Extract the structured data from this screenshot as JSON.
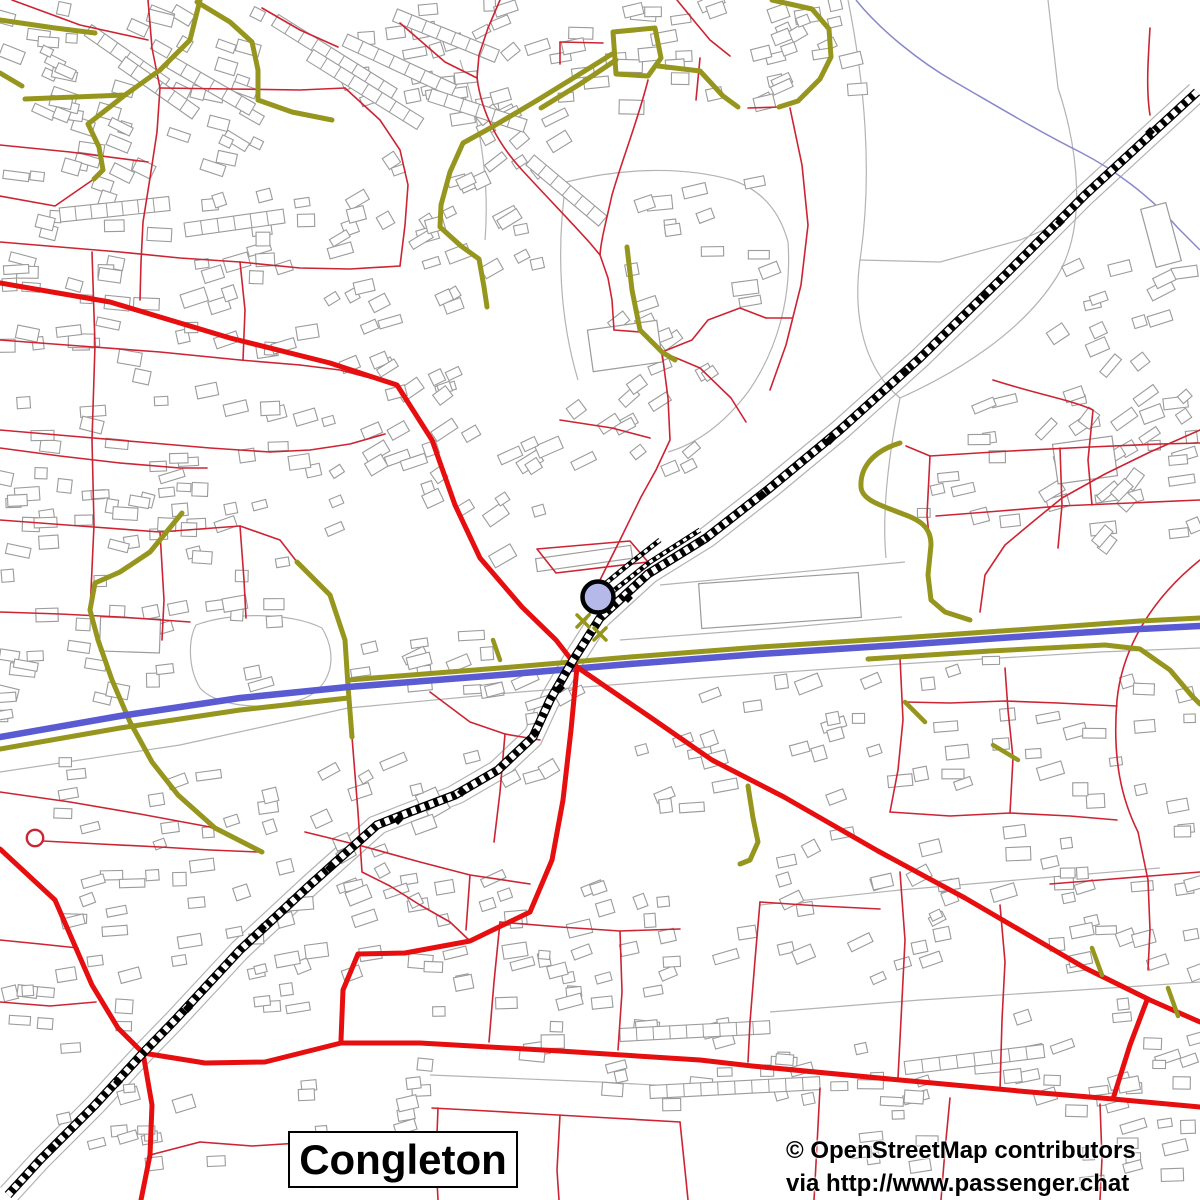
{
  "map": {
    "place_label": "Congleton",
    "attribution_line1": "© OpenStreetMap contributors",
    "attribution_line2": "via http://www.passenger.chat",
    "colors": {
      "background": "#ffffff",
      "road_minor": "#cd2332",
      "road_primary": "#e60e0e",
      "road_b": "#96961e",
      "trunk_blue": "#5a5ad2",
      "stream": "#8888cc",
      "building_stroke": "#9b9b9b",
      "boundary": "#b3b3b3",
      "railway": "#000000",
      "marker_fill": "#b4b9ea",
      "marker_stroke": "#000000",
      "label_text": "#000000"
    },
    "marker": {
      "cx": 598,
      "cy": 597,
      "r": 15.5
    },
    "roundabout": {
      "cx": 35,
      "cy": 838,
      "r": 8.2
    },
    "railway_points": [
      [
        1197,
        92
      ],
      [
        1085,
        195
      ],
      [
        1000,
        280
      ],
      [
        920,
        358
      ],
      [
        840,
        430
      ],
      [
        770,
        488
      ],
      [
        706,
        538
      ],
      [
        648,
        574
      ],
      [
        600,
        618
      ],
      [
        572,
        662
      ],
      [
        550,
        700
      ],
      [
        533,
        737
      ],
      [
        498,
        770
      ],
      [
        455,
        795
      ],
      [
        410,
        812
      ],
      [
        377,
        825
      ],
      [
        310,
        885
      ],
      [
        240,
        950
      ],
      [
        175,
        1020
      ],
      [
        143,
        1053
      ],
      [
        95,
        1105
      ],
      [
        40,
        1160
      ],
      [
        8,
        1195
      ]
    ],
    "railway_spurs": [
      [
        [
          700,
          530
        ],
        [
          650,
          562
        ],
        [
          612,
          592
        ],
        [
          588,
          612
        ]
      ],
      [
        [
          660,
          540
        ],
        [
          628,
          565
        ],
        [
          600,
          588
        ]
      ]
    ],
    "railway_diamonds": [
      [
        1150,
        132
      ],
      [
        1060,
        222
      ],
      [
        985,
        295
      ],
      [
        905,
        372
      ],
      [
        830,
        440
      ],
      [
        762,
        495
      ],
      [
        700,
        542
      ],
      [
        628,
        598
      ],
      [
        560,
        688
      ],
      [
        535,
        733
      ],
      [
        462,
        792
      ],
      [
        398,
        820
      ],
      [
        330,
        868
      ],
      [
        262,
        928
      ],
      [
        188,
        1008
      ],
      [
        118,
        1082
      ],
      [
        52,
        1148
      ]
    ],
    "trunk": {
      "blue": "M 0,737 L 120,716 240,698 348,687 500,675 630,664 760,654 900,645 1030,636 1140,629 1200,626",
      "casings": [
        "M 0,749 L 120,728 240,710 348,698",
        "M 348,680 L 500,668 630,657 760,647 900,638 1030,629 1140,621 1200,618",
        "M 868,659 L 990,651 1105,645 1140,649 1170,670 1192,696 1200,704"
      ]
    },
    "stream": "M 856,0 C 880,30 920,62 955,82 C 1000,108 1040,132 1080,152 C 1115,170 1150,196 1178,228 L 1200,250",
    "olive_roads": [
      "M 0,20 L 55,28 95,33",
      "M 0,73 L 22,86",
      "M 197,2 L 230,22 252,42 258,70 258,100",
      "M 258,100 L 292,112 332,120",
      "M 200,0 L 190,40 160,70 125,95 25,99",
      "M 125,95 L 88,124 99,147 103,170 94,179",
      "M 536,101 L 575,77 612,54",
      "M 541,108 L 580,84 616,60",
      "M 613,32 L 655,28 661,58 648,76 616,74 Z",
      "M 658,66 L 700,71 723,96 738,107",
      "M 772,0 L 812,9 829,29 831,57 820,79 798,101 779,107",
      "M 536,101 L 492,127 463,143 450,172 441,205 440,227 461,246 479,259 484,287 487,307",
      "M 627,247 L 632,290 640,330 662,352 675,360",
      "M 900,443 C 870,452 860,470 861,487 C 862,500 880,505 903,514 C 920,520 931,527 931,545 L 928,575 931,600 945,612 970,620",
      "M 297,562 L 330,595 345,640 348,686 352,737",
      "M 182,513 L 150,552 120,572 95,583 90,610 98,640 112,680 130,722 152,762 178,795 215,828 262,852",
      "M 748,786 L 753,818 758,842 750,860 740,864"
    ],
    "olive_marks": [
      "M 1092,948 L 1102,975",
      "M 1168,988 L 1178,1016",
      "M 493,640 L 500,660",
      "M 993,745 L 1018,760",
      "M 905,702 L 925,722"
    ],
    "crossing_marks": [
      [
        583,
        621
      ],
      [
        600,
        634
      ]
    ],
    "red_primary": [
      "M 0,283 L 110,302 230,338 330,363 397,385 432,440 455,505 480,558 522,607 556,640 577,667 650,717 712,760 784,797 878,851 965,898 1085,968 1150,1000 1200,1022",
      "M 577,667 L 571,730 563,800 552,860 530,912 470,941 405,953 358,954 343,990 341,1040",
      "M 0,849 L 55,900 92,985 118,1028 143,1053 205,1063 265,1062 341,1043 420,1043 560,1051 700,1060 752,1066 900,1080 1030,1092 1113,1099 1200,1107",
      "M 143,1053 L 152,1105 150,1155 141,1200",
      "M 1147,1000 L 1130,1045 1113,1099"
    ],
    "red_roads": [
      "M 12,0 L 80,25 148,40",
      "M 148,0 L 152,48 160,88 157,132 150,178 143,222 141,262 140,300",
      "M 160,88 L 230,89 300,90 345,88",
      "M 262,8 L 300,30 338,47",
      "M 400,23 L 445,62 477,78",
      "M 500,0 L 488,28 479,55 477,78",
      "M 477,78 C 482,115 500,146 522,170 C 546,196 573,224 590,243 L 600,255 608,278 612,300 614,330",
      "M 677,0 L 695,22 710,40 730,56",
      "M 648,80 C 638,120 622,160 612,195 C 606,222 601,240 600,255",
      "M 560,42 L 603,43",
      "M 560,42 L 560,64",
      "M 0,145 L 70,152 148,162",
      "M 0,196 L 55,206 94,179",
      "M 0,242 L 60,247 120,252 180,258 240,262",
      "M 240,262 L 300,268 350,269 400,266",
      "M 345,88 L 380,120 400,150 408,185 405,225 400,266",
      "M 0,340 L 80,346 160,352 240,360 300,365",
      "M 300,365 L 340,370 370,378 397,385",
      "M 240,262 L 245,310 243,360",
      "M 92,252 L 95,345 92,440",
      "M 0,430 L 70,436 140,442 210,448 270,452",
      "M 270,452 L 310,450 350,444 385,434",
      "M 92,440 L 94,525 90,612",
      "M 0,520 L 80,526 160,532 240,526",
      "M 240,526 L 280,540 297,562",
      "M 160,532 L 164,600 162,640",
      "M 0,612 L 60,614 120,617 190,622",
      "M 240,526 L 244,580 246,618",
      "M 1150,28 C 1148,60 1146,90 1150,115",
      "M 700,58 L 696,100",
      "M 662,352 L 692,340 708,320 740,308 766,318",
      "M 766,318 L 792,318",
      "M 662,352 L 700,368 731,398 746,422",
      "M 662,352 L 668,398 670,440 656,470 641,497 620,540 605,570 598,584",
      "M 560,420 L 612,428 650,438",
      "M 748,108 L 779,107",
      "M 790,108 L 802,165 808,225 801,285 786,345 770,390",
      "M 537,549 L 630,541 648,562 556,573 Z",
      "M 930,456 L 1010,451 1090,447 1160,444 1200,443",
      "M 930,456 L 927,515 931,556",
      "M 1060,448 L 1062,505 1058,548",
      "M 1200,500 L 1130,503 1060,506 1000,511 936,516",
      "M 930,456 L 906,446",
      "M 1200,430 L 1150,452 1105,474 1062,498 1035,520 1005,545 985,575 980,612",
      "M 1200,560 C 1150,600 1122,650 1117,700 C 1112,760 1122,800 1138,832 L 1148,880 1150,930 1148,970",
      "M 900,658 L 903,720 898,770 890,812",
      "M 890,812 L 950,816 1010,813 1070,816 1117,820",
      "M 1010,813 L 1013,758 1008,710 1005,668",
      "M 1117,706 L 1058,703 1005,701 950,703 905,702",
      "M 900,872 L 905,940 902,1000 898,1078",
      "M 1000,905 L 1005,962 1002,1020 1000,1090",
      "M 760,902 L 820,906 880,909",
      "M 760,902 L 755,960 750,1022 748,1062",
      "M 1200,872 L 1150,876 1100,880 1050,884",
      "M 950,1098 L 945,1150 941,1200",
      "M 1100,1104 L 1102,1158 1100,1200",
      "M 820,1088 L 817,1145 814,1200",
      "M 500,922 L 560,927 620,931 680,929",
      "M 620,931 L 622,992 618,1050",
      "M 500,922 L 494,982 489,1042",
      "M 680,1122 L 610,1118 540,1114 470,1110 432,1108",
      "M 560,1115 L 557,1170 559,1200",
      "M 438,1108 L 436,1160 438,1200",
      "M 680,1122 L 686,1180 688,1200",
      "M 305,832 L 362,846 420,862 470,875 530,884",
      "M 470,875 L 466,930",
      "M 0,1002 L 50,1006 96,1002",
      "M 200,1142 L 252,1146 300,1143",
      "M 150,1155 L 200,1142",
      "M 43,841 L 100,844 160,847 210,850 258,852",
      "M 430,692 L 470,722 505,734 540,740",
      "M 505,734 L 500,792 494,842",
      "M 352,737 L 358,812 362,872 390,886",
      "M 0,792 L 70,802 140,814 210,827 262,852",
      "M 390,886 L 420,905 450,922 470,941",
      "M 0,448 L 60,456 120,463",
      "M 120,463 L 180,468 207,468",
      "M 0,940 L 40,944 78,948",
      "M 993,380 C 1040,395 1072,400 1093,410 L 1088,460 1092,505",
      "M 614,330 L 640,332 662,352"
    ],
    "gray_paths": [
      "M 0,772 L 180,745 348,708 520,692 700,678 900,664 1100,652 1200,648",
      "M 620,640 L 780,628 902,617",
      "M 848,0 C 866,90 872,180 860,260 C 852,320 866,370 900,398",
      "M 900,398 C 958,372 1022,332 1056,278 C 1088,228 1078,148 1058,88 L 1048,0",
      "M 860,260 L 940,262 1020,240 1058,224",
      "M 900,398 C 888,458 882,515 886,558",
      "M 566,182 C 622,168 682,166 732,180 C 762,190 780,212 788,242",
      "M 788,242 C 792,300 776,352 748,392 C 724,424 696,444 668,452",
      "M 566,182 C 556,250 560,320 578,380",
      "M 196,625 C 230,612 290,612 322,628 C 340,658 330,690 300,700 C 258,712 215,705 200,688 C 188,668 188,640 196,625 Z",
      "M 760,905 L 900,890 1040,878 1160,868",
      "M 770,1012 L 920,1000 1080,990 1200,982",
      "M 430,1075 L 600,1082 780,1092",
      "M 660,585 L 905,562",
      "M 460,60 C 480,120 490,180 485,240"
    ],
    "building_zones": [
      [
        0,
        5,
        150,
        195,
        36,
        15
      ],
      [
        150,
        0,
        110,
        170,
        22,
        20
      ],
      [
        340,
        0,
        170,
        135,
        24,
        -12
      ],
      [
        0,
        215,
        150,
        175,
        26,
        5
      ],
      [
        150,
        190,
        170,
        170,
        26,
        -8
      ],
      [
        320,
        150,
        140,
        180,
        22,
        -25
      ],
      [
        470,
        20,
        90,
        160,
        14,
        -30
      ],
      [
        560,
        0,
        130,
        120,
        18,
        -5
      ],
      [
        700,
        0,
        110,
        110,
        14,
        -20
      ],
      [
        0,
        400,
        150,
        195,
        28,
        3
      ],
      [
        150,
        380,
        180,
        200,
        30,
        -8
      ],
      [
        330,
        360,
        130,
        170,
        22,
        -25
      ],
      [
        570,
        300,
        140,
        170,
        20,
        -30
      ],
      [
        0,
        610,
        130,
        125,
        16,
        2
      ],
      [
        140,
        600,
        200,
        115,
        12,
        -5
      ],
      [
        360,
        600,
        130,
        90,
        11,
        -15
      ],
      [
        60,
        760,
        230,
        145,
        24,
        -10
      ],
      [
        300,
        760,
        140,
        130,
        14,
        -20
      ],
      [
        0,
        900,
        140,
        150,
        16,
        -5
      ],
      [
        150,
        880,
        170,
        130,
        16,
        -10
      ],
      [
        340,
        850,
        180,
        130,
        18,
        -15
      ],
      [
        420,
        950,
        180,
        120,
        16,
        -5
      ],
      [
        540,
        880,
        190,
        130,
        18,
        -12
      ],
      [
        600,
        1000,
        280,
        105,
        22,
        -4
      ],
      [
        300,
        1080,
        180,
        110,
        14,
        -6
      ],
      [
        60,
        1060,
        160,
        120,
        12,
        -10
      ],
      [
        740,
        830,
        220,
        150,
        24,
        -18
      ],
      [
        970,
        820,
        230,
        170,
        26,
        -10
      ],
      [
        1010,
        1000,
        190,
        130,
        20,
        -8
      ],
      [
        860,
        1060,
        330,
        130,
        24,
        -6
      ],
      [
        640,
        680,
        240,
        130,
        22,
        -12
      ],
      [
        900,
        660,
        300,
        150,
        26,
        -8
      ],
      [
        920,
        390,
        280,
        160,
        28,
        -12
      ],
      [
        1050,
        255,
        140,
        100,
        11,
        -18
      ],
      [
        1040,
        330,
        150,
        230,
        20,
        -42
      ],
      [
        470,
        680,
        120,
        110,
        11,
        -20
      ],
      [
        620,
        180,
        160,
        130,
        14,
        -10
      ],
      [
        420,
        180,
        120,
        120,
        12,
        -20
      ],
      [
        780,
        0,
        90,
        100,
        9,
        -15
      ],
      [
        430,
        430,
        120,
        130,
        14,
        -28
      ]
    ],
    "terraces": [
      [
        275,
        20,
        140,
        13,
        32,
        9
      ],
      [
        310,
        55,
        130,
        13,
        32,
        8
      ],
      [
        345,
        40,
        120,
        13,
        25,
        7
      ],
      [
        395,
        15,
        110,
        13,
        22,
        7
      ],
      [
        88,
        30,
        95,
        13,
        35,
        6
      ],
      [
        122,
        62,
        90,
        13,
        35,
        6
      ],
      [
        170,
        62,
        95,
        13,
        30,
        6
      ],
      [
        430,
        95,
        100,
        13,
        18,
        6
      ],
      [
        60,
        215,
        110,
        14,
        -6,
        7
      ],
      [
        185,
        230,
        100,
        14,
        -8,
        6
      ],
      [
        620,
        1035,
        150,
        13,
        -3,
        9
      ],
      [
        650,
        1092,
        170,
        13,
        -3,
        10
      ],
      [
        905,
        1068,
        140,
        13,
        -7,
        8
      ],
      [
        530,
        160,
        95,
        13,
        40,
        6
      ]
    ],
    "large_buildings": [
      [
        536,
        552,
        96,
        13,
        -8
      ],
      [
        700,
        578,
        160,
        45,
        -4
      ],
      [
        1055,
        440,
        60,
        40,
        -8
      ],
      [
        100,
        618,
        60,
        34,
        2
      ],
      [
        590,
        325,
        70,
        42,
        -8
      ],
      [
        1148,
        205,
        26,
        60,
        -15
      ]
    ],
    "seed": 7
  }
}
